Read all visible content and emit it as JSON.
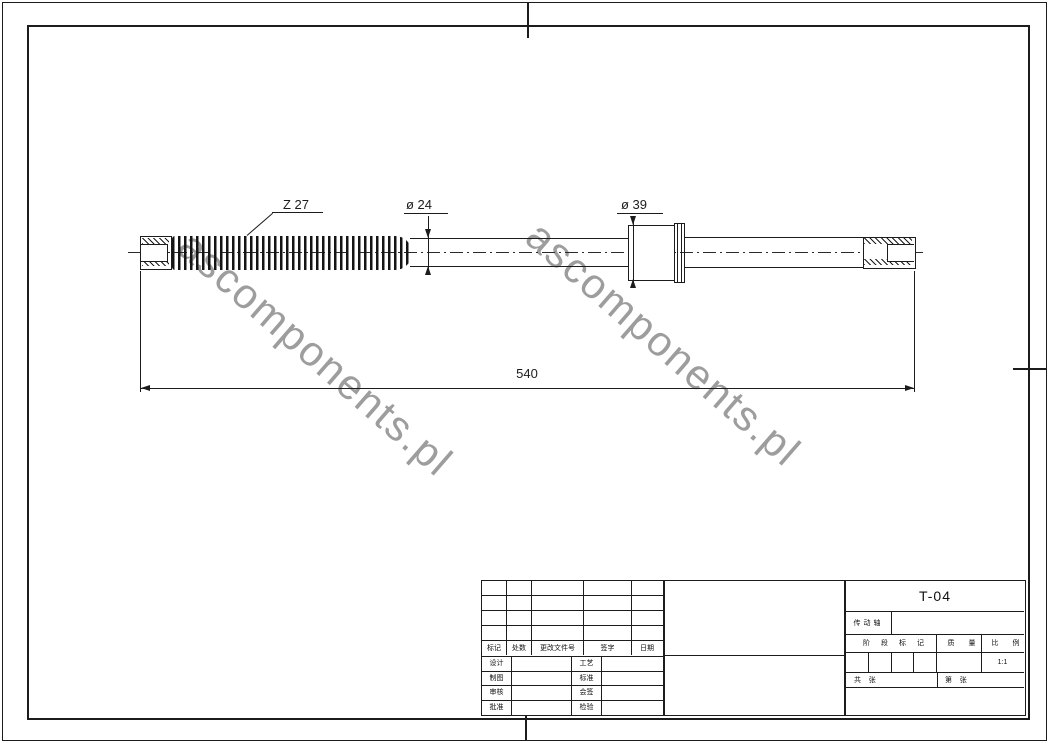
{
  "drawing": {
    "labels": {
      "spline_teeth": "Z 27",
      "shaft_diameter": "ø 24",
      "flange_diameter": "ø 39",
      "overall_length": "540"
    },
    "watermark_text": "ascomponents.pl"
  },
  "revision_table": {
    "headers": [
      "标记",
      "处数",
      "更改文件号",
      "签字",
      "日期"
    ]
  },
  "signature_table": {
    "rows": [
      {
        "left": "设计",
        "right": "工艺"
      },
      {
        "left": "制图",
        "right": "标准"
      },
      {
        "left": "审核",
        "right": "会签"
      },
      {
        "left": "批准",
        "right": "检验"
      }
    ]
  },
  "title_block": {
    "drawing_number": "T-04",
    "part_name": "传动轴",
    "stage_header": "阶段标记",
    "mass_header": "质量",
    "scale_header": "比例",
    "scale_value": "1:1",
    "sheets_total": "共    张",
    "sheet_number": "第    张"
  },
  "colors": {
    "line": "#1c1c1c",
    "watermark": "#8d8d8d",
    "background": "#ffffff"
  }
}
